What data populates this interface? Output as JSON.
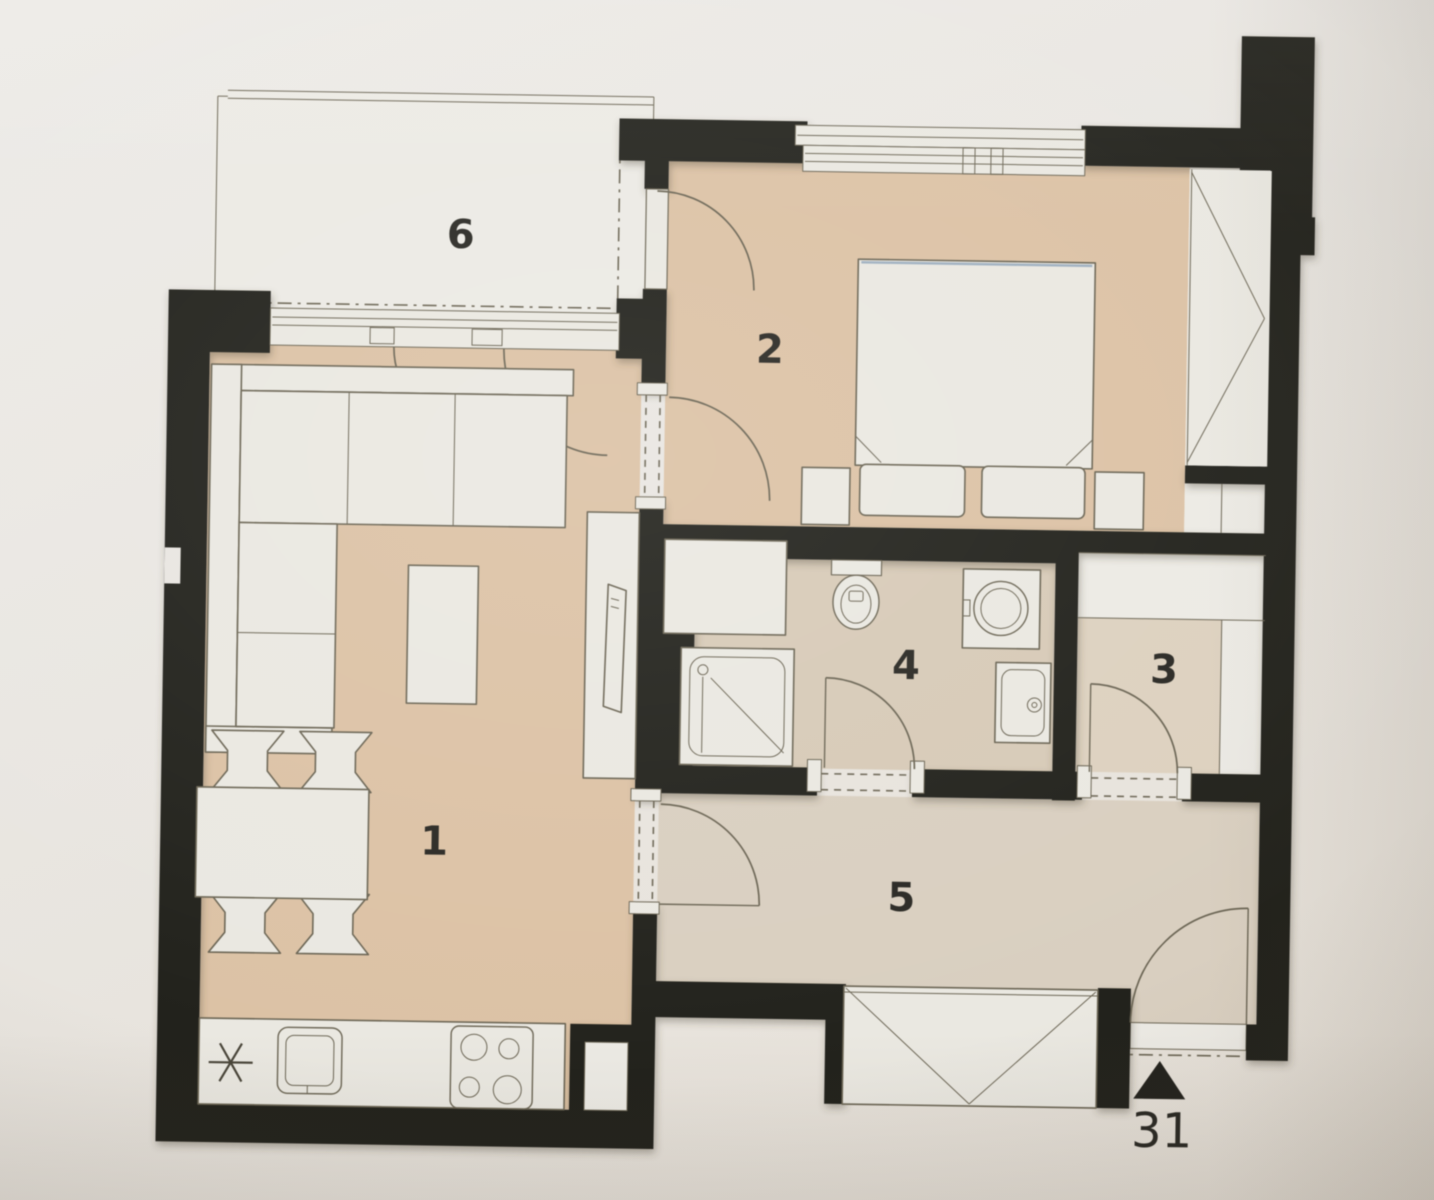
{
  "plan": {
    "unit_label": "31",
    "rooms": [
      {
        "id": "living-room-kitchen",
        "number": "1"
      },
      {
        "id": "bedroom",
        "number": "2"
      },
      {
        "id": "storage-closet",
        "number": "3"
      },
      {
        "id": "bathroom",
        "number": "4"
      },
      {
        "id": "hallway",
        "number": "5"
      },
      {
        "id": "balcony",
        "number": "6"
      }
    ],
    "entry": {
      "label": "31",
      "marker": "entrance-arrow-icon",
      "direction": "up"
    },
    "fixtures": {
      "living_room_kitchen": [
        "corner-sofa",
        "coffee-table",
        "tv-sideboard",
        "tv",
        "dining-table",
        "dining-chairs",
        "kitchen-counter",
        "kitchen-sink",
        "cooktop-4-burners",
        "utility-star-symbol"
      ],
      "bedroom": [
        "double-bed",
        "pillows",
        "nightstand-left",
        "nightstand-right",
        "built-in-wardrobe",
        "balcony-door",
        "window"
      ],
      "bathroom": [
        "shower-cabin",
        "toilet",
        "washing-machine",
        "washbasin",
        "cabinet"
      ],
      "hallway": [
        "wardrobe",
        "entry-door",
        "threshold"
      ],
      "storage_closet": [
        "shelving",
        "closet"
      ],
      "balcony": [
        "railing",
        "french-doors-to-living-room"
      ]
    },
    "colors": {
      "paper": "#e9e6e1",
      "wall": "#23221d",
      "floor_main": "#dcc2a5",
      "floor_secondary": "#d9cfc0",
      "floor_bath": "#d7cab7",
      "floor_storage": "#ddd1bf",
      "floor_light": "#eceae4",
      "furniture_fill": "#eae8e1",
      "line": "#6c6655",
      "bed_accent": "#9fb0c0",
      "text": "#2a2924"
    }
  }
}
